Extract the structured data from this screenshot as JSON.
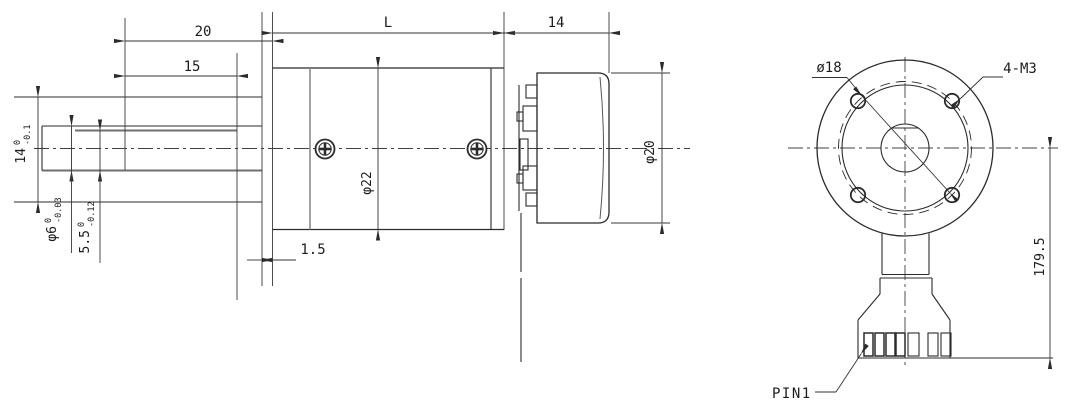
{
  "drawing": {
    "kind": "gear-motor dimensional drawing",
    "colors": {
      "line": "#2b2b2b",
      "dim": "#333333",
      "soft": "#6f6f6f",
      "background": "#ffffff"
    },
    "side_view": {
      "dim_shaft_length": "20",
      "dim_flat_length": "15",
      "dim_gearbox_length": "L",
      "dim_motor_length": "14",
      "dim_front_plate": "1.5",
      "dim_boss_diameter": {
        "value": "14",
        "tol_upper": "0",
        "tol_lower": "-0.1"
      },
      "dim_shaft_diameter": {
        "value": "φ6",
        "tol_upper": "0",
        "tol_lower": "-0.03"
      },
      "dim_flat_height": {
        "value": "5.5",
        "tol_upper": "0",
        "tol_lower": "-0.12"
      },
      "dim_gearbox_diameter": "φ22",
      "dim_motor_diameter": "φ20"
    },
    "front_view": {
      "dim_bolt_circle": "ø18",
      "dim_mounting_holes": "4-M3",
      "dim_connector_distance": "179.5",
      "pin_label": "PIN1"
    }
  }
}
